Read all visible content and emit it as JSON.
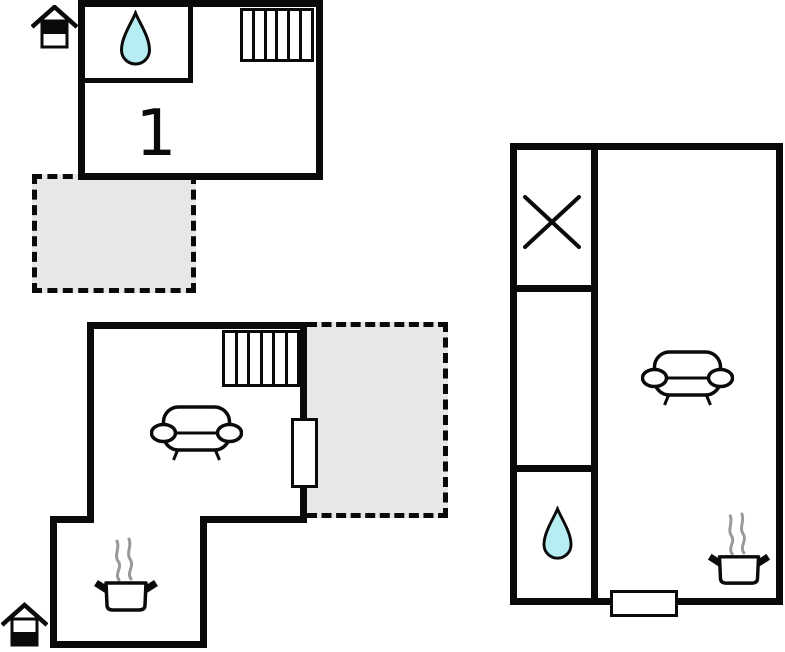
{
  "page": {
    "type": "floor-plan",
    "background": "#ffffff"
  },
  "colors": {
    "wall": "#0a0a0a",
    "line": "#0a0a0a",
    "outdoor_area_fill": "#e7e7e7",
    "water_drop_fill": "#b5edf2",
    "steam": "#999999",
    "paper": "#ffffff"
  },
  "labels": {
    "room1": "1"
  },
  "icons": {
    "upper_floor_indicator": "house-top-half-filled-icon",
    "ground_floor_indicator": "house-bottom-half-filled-icon",
    "bathroom": "water-drop-icon",
    "stairs": "stairs-icon",
    "sofa": "sofa-icon",
    "stove": "pot-with-steam-icon",
    "storage": "cross-icon",
    "door": "door-marker"
  },
  "structures": {
    "upper_floor": {
      "room_label": "1",
      "features": [
        "water-drop",
        "stairs"
      ],
      "outdoor": "dashed-terrace"
    },
    "ground_floor_main": {
      "features": [
        "stairs",
        "sofa",
        "pot-with-steam",
        "door"
      ],
      "outdoor": "dashed-terrace"
    },
    "annex": {
      "features": [
        "cross-storage",
        "water-drop",
        "sofa",
        "pot-with-steam",
        "door"
      ]
    }
  }
}
